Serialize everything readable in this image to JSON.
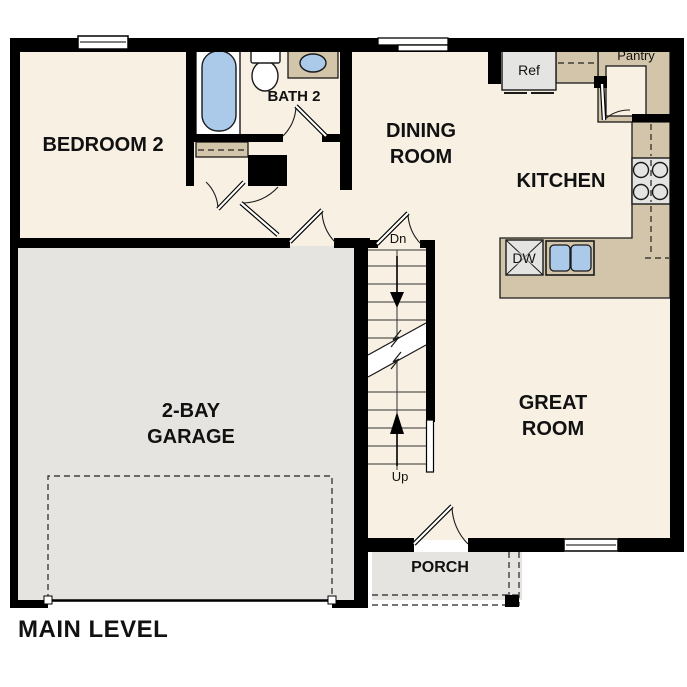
{
  "title": "MAIN LEVEL",
  "colors": {
    "floor": "#f7f0e3",
    "garage": "#e5e4e1",
    "counter": "#d3c5a9",
    "blue": "#abc9e9",
    "appliance": "#e4e4e2",
    "wall": "#000000",
    "ink": "#1a1a1a"
  },
  "rooms": {
    "bedroom2": {
      "label": "BEDROOM 2"
    },
    "bath2": {
      "label": "BATH 2"
    },
    "dining": {
      "line1": "DINING",
      "line2": "ROOM"
    },
    "kitchen": {
      "label": "KITCHEN"
    },
    "great": {
      "line1": "GREAT",
      "line2": "ROOM"
    },
    "garage": {
      "line1": "2-BAY",
      "line2": "GARAGE"
    },
    "porch": {
      "label": "PORCH"
    }
  },
  "fixtures": {
    "refrigerator": "Ref",
    "pantry": "Pantry",
    "dishwasher": "DW"
  },
  "stairs": {
    "down": "Dn",
    "up": "Up"
  }
}
